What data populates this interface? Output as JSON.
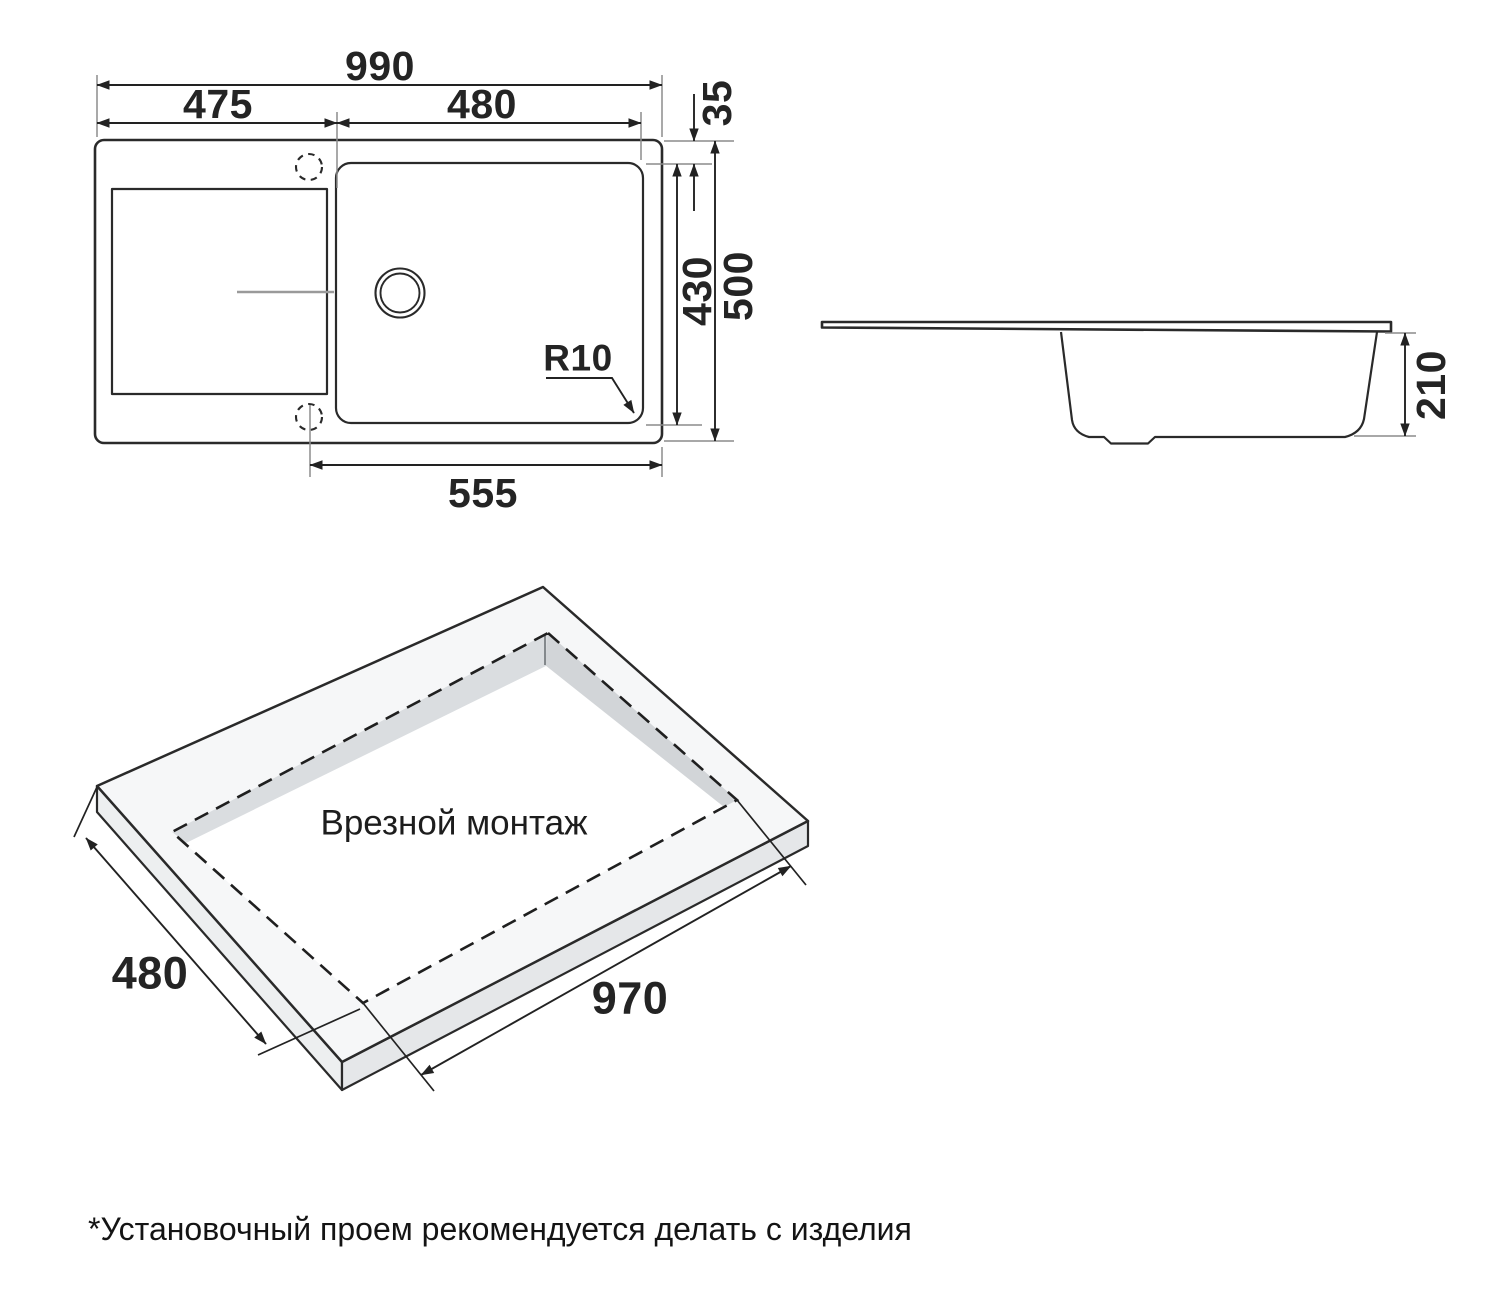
{
  "top_view": {
    "overall_width": "990",
    "drainer_width": "475",
    "bowl_width": "480",
    "rim_offset": "35",
    "bowl_depth": "430",
    "overall_depth": "500",
    "bottom_span": "555",
    "corner_radius": "R10"
  },
  "side_view": {
    "bowl_height": "210"
  },
  "iso_view": {
    "cutout_width": "480",
    "cutout_length": "970",
    "title": "Врезной монтаж"
  },
  "footnote": "*Установочный проем рекомендуется делать с изделия",
  "colors": {
    "line": "#2a2a2a",
    "extension_line": "#8c8c8c",
    "groove": "#9a9a9a",
    "slab_top": "#f6f7f8",
    "slab_side_left": "#edeff0",
    "slab_side_right": "#e5e7e9",
    "cutout_wall_left": "#dadde0",
    "cutout_wall_right": "#d2d5d8",
    "background": "#ffffff"
  }
}
